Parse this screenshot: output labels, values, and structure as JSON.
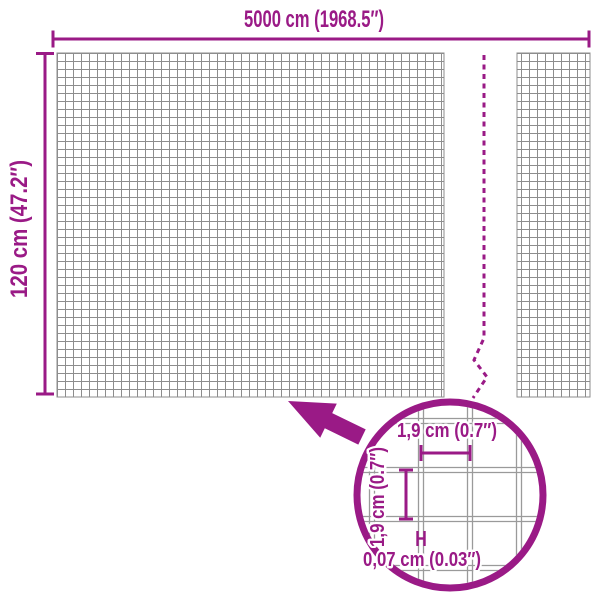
{
  "colors": {
    "accent": "#9A1A86",
    "mesh_line": "#8D8D8D",
    "wire_line": "#9A9A9A",
    "background": "#FFFFFF"
  },
  "overall": {
    "width_label": "5000 cm (1968.5″)",
    "height_label": "120 cm (47.2″)"
  },
  "detail": {
    "opening_width_label": "1,9 cm (0.7″)",
    "opening_height_label": "1,9 cm (0.7″)",
    "wire_thickness_label": "0,07 cm (0.03″)"
  }
}
